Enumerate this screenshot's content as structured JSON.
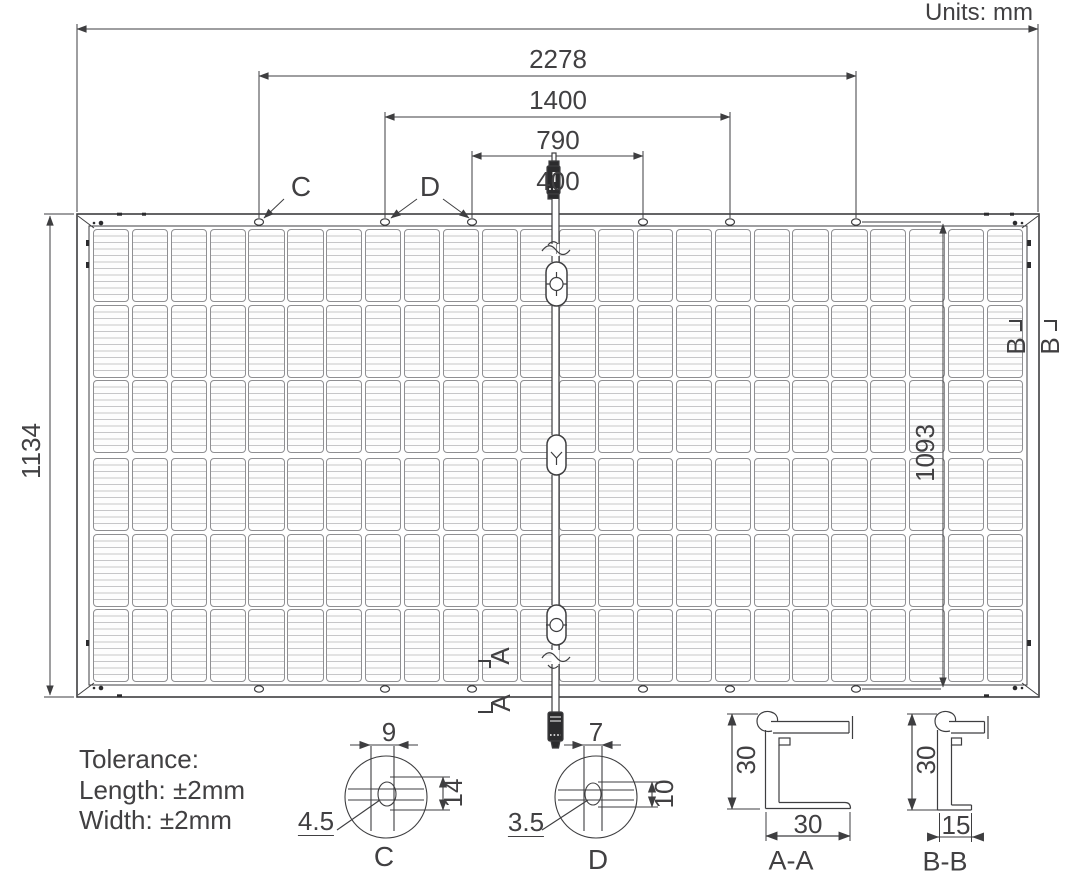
{
  "meta": {
    "units_label": "Units: mm"
  },
  "dimensions": {
    "top": [
      "2278",
      "1400",
      "790",
      "400"
    ],
    "panel_width": "1134",
    "hole_span_vertical": "1093"
  },
  "tolerance": {
    "title": "Tolerance:",
    "length": "Length: ±2mm",
    "width": "Width: ±2mm"
  },
  "markers": {
    "hole_c": "C",
    "hole_d": "D",
    "section_a": "A",
    "section_b": "B"
  },
  "details": {
    "c": {
      "title": "C",
      "slot_width": "9",
      "slot_height": "14",
      "hole_size": "4.5"
    },
    "d": {
      "title": "D",
      "slot_width": "7",
      "slot_height": "10",
      "hole_size": "3.5"
    }
  },
  "sections": {
    "aa": {
      "title": "A-A",
      "frame_height": "30",
      "frame_width": "30"
    },
    "bb": {
      "title": "B-B",
      "frame_height": "30",
      "frame_width": "15"
    }
  },
  "panel": {
    "columns": 24,
    "rows_per_half": 3,
    "halves": 2
  },
  "colors": {
    "line": "#3e3e40",
    "text": "#414042",
    "cell_border": "#8f8f92",
    "busbar": "#c6c6c8",
    "connector": "#2b2b2d"
  }
}
